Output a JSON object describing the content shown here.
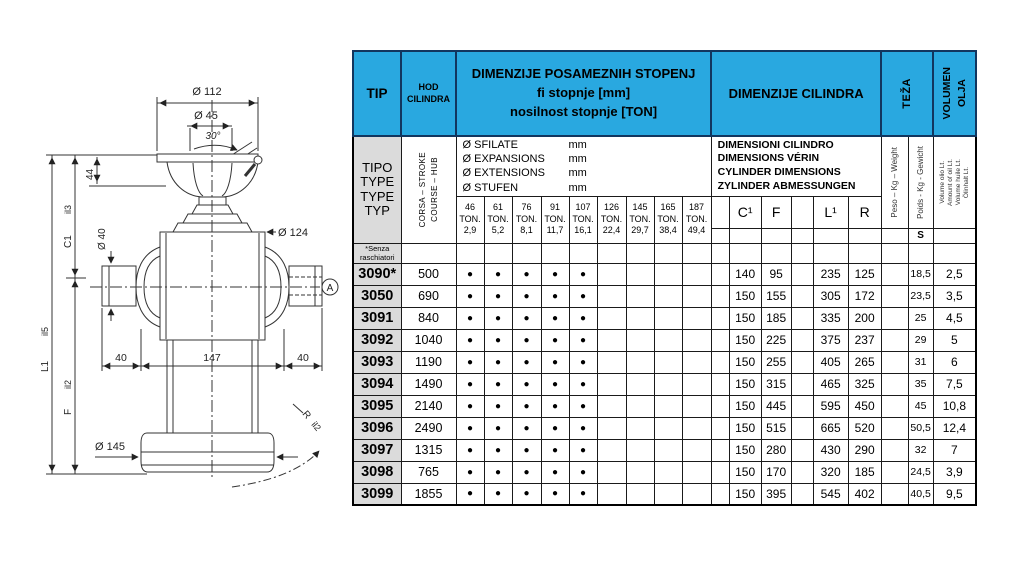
{
  "colors": {
    "header_blue": "#29A8E0",
    "header_border": "#12365F",
    "tip_grey": "#DBDBDB",
    "grid_black": "#000000"
  },
  "diagram": {
    "dims": {
      "top_flange_dia": "Ø 112",
      "ball_dia": "Ø 45",
      "angle": "30°",
      "head_height": "44",
      "pin_dia": "Ø 40",
      "body_dia": "Ø 124",
      "pin_len_left": "40",
      "body_width": "147",
      "pin_len_right": "40",
      "base_dia": "Ø 145",
      "closed_len": "C1",
      "closed_len_sub": "il3",
      "total_len": "L1",
      "total_len_sub": "il5",
      "lower_len": "F",
      "lower_len_sub": "il2",
      "radius": "R",
      "radius_sub": "il2",
      "section_marker": "A"
    }
  },
  "table": {
    "header": {
      "tip": "TIP",
      "hod_lines": [
        "HOD",
        "CILINDRA"
      ],
      "stopnje_lines": [
        "DIMENZIJE POSAMEZNIH STOPENJ",
        "fi stopnje [mm]",
        "nosilnost stopnje [TON]"
      ],
      "cilindra": "DIMENZIJE CILINDRA",
      "teza": "TEŽA",
      "volumen_lines": [
        "VOLUMEN",
        "OLJA"
      ]
    },
    "subheader": {
      "tipo_lines": [
        "TIPO",
        "TYPE",
        "TYPE",
        "TYP"
      ],
      "corsa_lines": [
        "CORSA – STROKE",
        "COURSE – HUB"
      ],
      "sfilate_rows": [
        {
          "label": "Ø SFILATE",
          "unit": "mm"
        },
        {
          "label": "Ø EXPANSIONS",
          "unit": "mm"
        },
        {
          "label": "Ø EXTENSIONS",
          "unit": "mm"
        },
        {
          "label": "Ø STUFEN",
          "unit": "mm"
        }
      ],
      "dimensioni_lines": [
        "DIMENSIONI CILINDRO",
        "DIMENSIONS VÉRIN",
        "CYLINDER DIMENSIONS",
        "ZYLINDER ABMESSUNGEN"
      ],
      "peso": "Peso – Kg – Weight",
      "poids": "Poids - Kg - Gewicht",
      "s_label": "S",
      "volume_lines": [
        "Volume olio Lt.",
        "Amount of oil Lt.",
        "Volume huile Lt.",
        "Ölinhalt Lt."
      ],
      "col_c1": "C¹",
      "col_f": "F",
      "col_l1": "L¹",
      "col_r": "R"
    },
    "ton_columns": [
      {
        "dia": "46",
        "ton": "TON.",
        "cap": "2,9"
      },
      {
        "dia": "61",
        "ton": "TON.",
        "cap": "5,2"
      },
      {
        "dia": "76",
        "ton": "TON.",
        "cap": "8,1"
      },
      {
        "dia": "91",
        "ton": "TON.",
        "cap": "11,7"
      },
      {
        "dia": "107",
        "ton": "TON.",
        "cap": "16,1"
      },
      {
        "dia": "126",
        "ton": "TON.",
        "cap": "22,4"
      },
      {
        "dia": "145",
        "ton": "TON.",
        "cap": "29,7"
      },
      {
        "dia": "165",
        "ton": "TON.",
        "cap": "38,4"
      },
      {
        "dia": "187",
        "ton": "TON.",
        "cap": "49,4"
      }
    ],
    "note_lines": [
      "*Senza",
      "raschiatori"
    ],
    "rows": [
      {
        "tip": "3090*",
        "hod": "500",
        "dots": 5,
        "c1": "140",
        "f": "95",
        "l1": "235",
        "r": "125",
        "kg": "18,5",
        "lt": "2,5"
      },
      {
        "tip": "3050",
        "hod": "690",
        "dots": 5,
        "c1": "150",
        "f": "155",
        "l1": "305",
        "r": "172",
        "kg": "23,5",
        "lt": "3,5"
      },
      {
        "tip": "3091",
        "hod": "840",
        "dots": 5,
        "c1": "150",
        "f": "185",
        "l1": "335",
        "r": "200",
        "kg": "25",
        "lt": "4,5"
      },
      {
        "tip": "3092",
        "hod": "1040",
        "dots": 5,
        "c1": "150",
        "f": "225",
        "l1": "375",
        "r": "237",
        "kg": "29",
        "lt": "5"
      },
      {
        "tip": "3093",
        "hod": "1190",
        "dots": 5,
        "c1": "150",
        "f": "255",
        "l1": "405",
        "r": "265",
        "kg": "31",
        "lt": "6"
      },
      {
        "tip": "3094",
        "hod": "1490",
        "dots": 5,
        "c1": "150",
        "f": "315",
        "l1": "465",
        "r": "325",
        "kg": "35",
        "lt": "7,5"
      },
      {
        "tip": "3095",
        "hod": "2140",
        "dots": 5,
        "c1": "150",
        "f": "445",
        "l1": "595",
        "r": "450",
        "kg": "45",
        "lt": "10,8"
      },
      {
        "tip": "3096",
        "hod": "2490",
        "dots": 5,
        "c1": "150",
        "f": "515",
        "l1": "665",
        "r": "520",
        "kg": "50,5",
        "lt": "12,4"
      },
      {
        "tip": "3097",
        "hod": "1315",
        "dots": 5,
        "c1": "150",
        "f": "280",
        "l1": "430",
        "r": "290",
        "kg": "32",
        "lt": "7"
      },
      {
        "tip": "3098",
        "hod": "765",
        "dots": 5,
        "c1": "150",
        "f": "170",
        "l1": "320",
        "r": "185",
        "kg": "24,5",
        "lt": "3,9"
      },
      {
        "tip": "3099",
        "hod": "1855",
        "dots": 5,
        "c1": "150",
        "f": "395",
        "l1": "545",
        "r": "402",
        "kg": "40,5",
        "lt": "9,5"
      }
    ]
  }
}
